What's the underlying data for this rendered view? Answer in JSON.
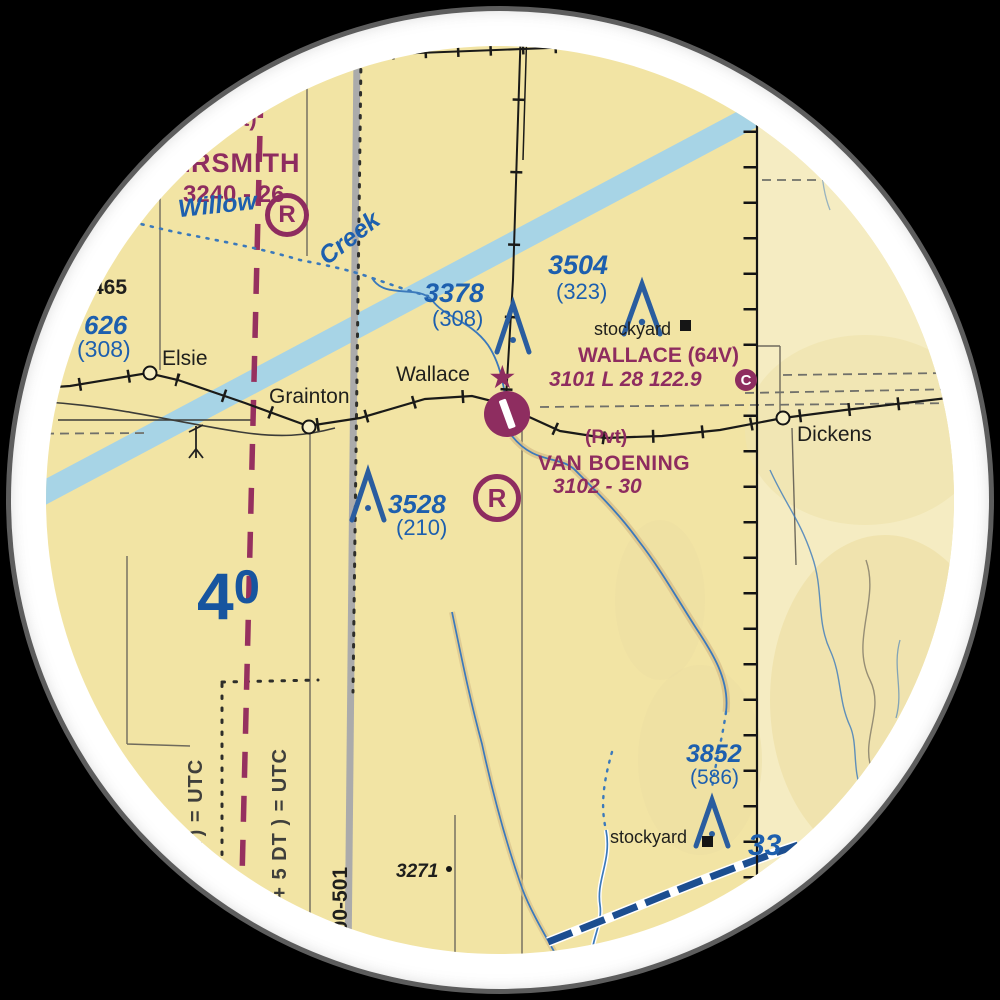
{
  "scene": {
    "background": "#000000",
    "sticker_ring": "#ffffff",
    "paper": "#f2e4a4",
    "paper_east": "#f5ecc2",
    "water_band": "#a7d4e6",
    "stream_blue": "#3b79bb",
    "canal_blue": "#1c4e90",
    "magenta": "#8e2c5f",
    "label_blue": "#1d5fae",
    "gray_band": "#ababab"
  },
  "labels": {
    "nw_fragment": "t)",
    "nw_airport_name": "ERSMITH",
    "nw_airport_data": "3240 - 26",
    "creek_d": "d",
    "willow": "Willow",
    "creek": "Creek",
    "r_symbol": "R",
    "elev_3378": "3378",
    "elev_3378_agl": "(308)",
    "elev_3504": "3504",
    "elev_3504_agl": "(323)",
    "stockyard_north": "stockyard",
    "wallace_airport_name": "WALLACE (64V)",
    "wallace_airport_data": "3101 L 28 122.9",
    "ctaf_symbol": "C",
    "town_wallace": "Wallace",
    "town_elsie": "Elsie",
    "town_grainton": "Grainton",
    "town_dickens": "Dickens",
    "pvt": "(Pvt)",
    "van_boening_name": "VAN BOENING",
    "van_boening_data": "3102 - 30",
    "elev_3528": "3528",
    "elev_3528_agl": "(210)",
    "lat_digit_4": "4",
    "lat_digit_0": "0",
    "spot_465": "465",
    "elev_626": "626",
    "elev_626_agl": "(308)",
    "utc_west": "DT) = UTC",
    "utc_east": "( + 5 DT ) = UTC",
    "powerline": "500-501",
    "spot_3271": "3271",
    "elev_3852": "3852",
    "elev_3852_agl": "(586)",
    "lon_33": "33",
    "stockyard_south": "stockyard"
  },
  "icons": {
    "beacon_star": "★"
  }
}
